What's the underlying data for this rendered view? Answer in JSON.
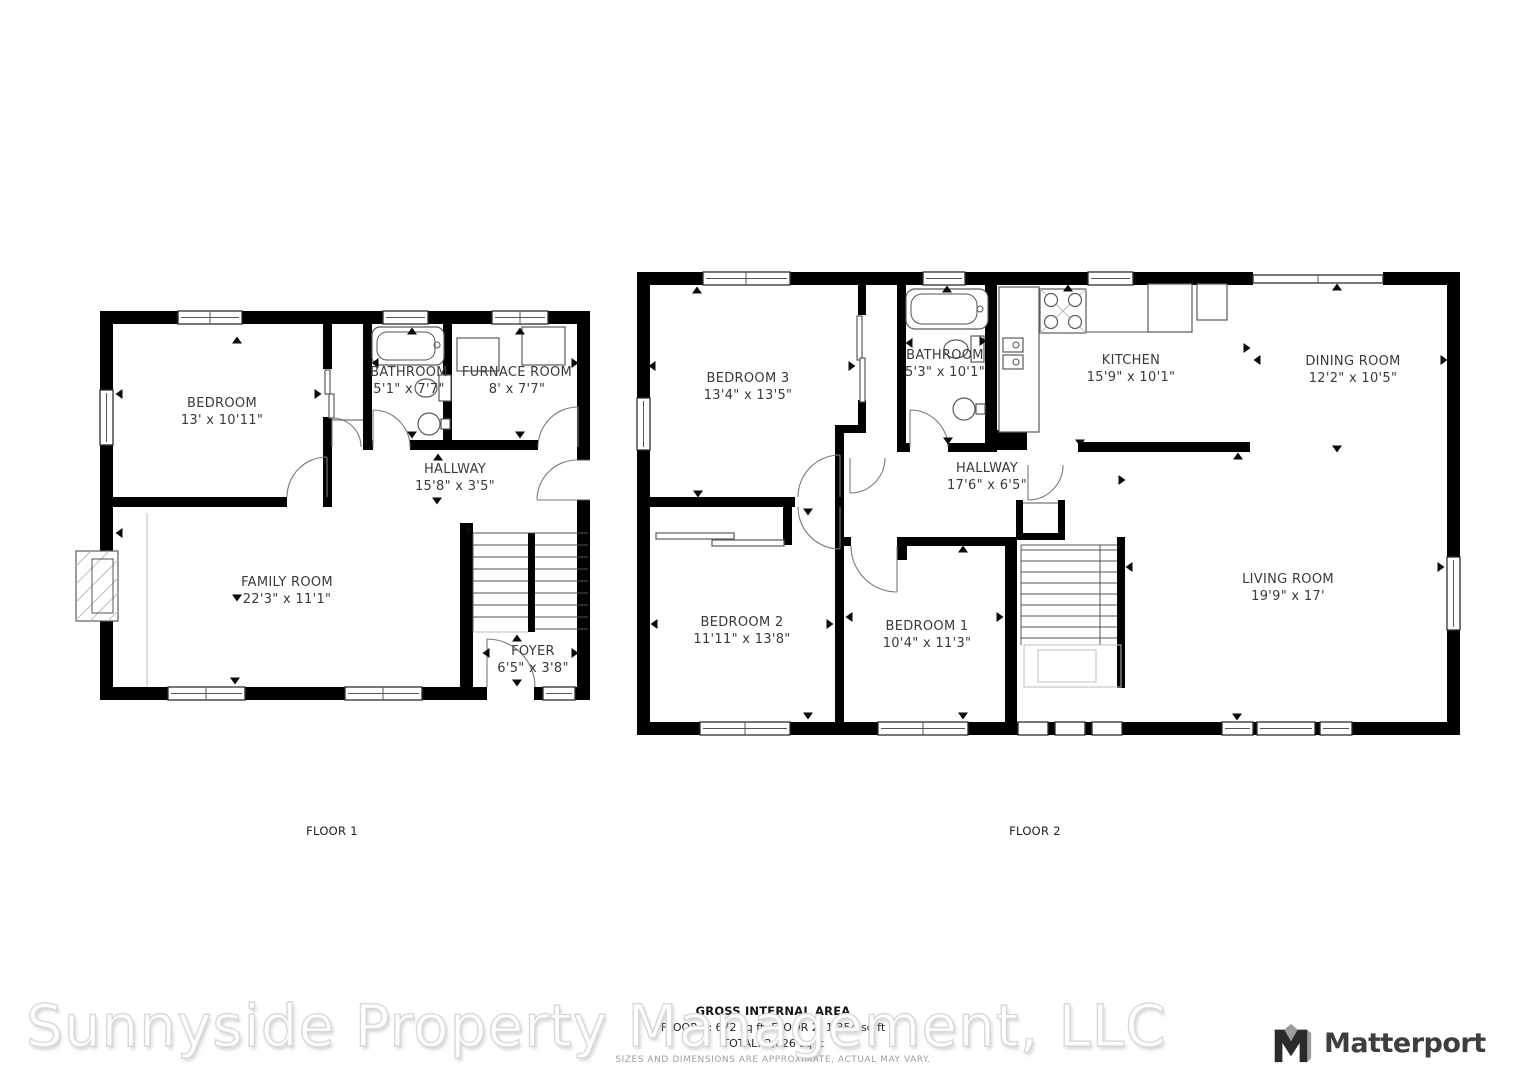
{
  "floors": [
    {
      "caption": "FLOOR 1",
      "rooms": [
        {
          "name": "BEDROOM",
          "dims": "13' x 10'11\""
        },
        {
          "name": "BATHROOM",
          "dims": "5'1\" x 7'7\""
        },
        {
          "name": "FURNACE ROOM",
          "dims": "8' x 7'7\""
        },
        {
          "name": "HALLWAY",
          "dims": "15'8\" x 3'5\""
        },
        {
          "name": "FAMILY ROOM",
          "dims": "22'3\" x 11'1\""
        },
        {
          "name": "FOYER",
          "dims": "6'5\" x 3'8\""
        }
      ]
    },
    {
      "caption": "FLOOR 2",
      "rooms": [
        {
          "name": "BEDROOM 3",
          "dims": "13'4\" x 13'5\""
        },
        {
          "name": "BATHROOM",
          "dims": "5'3\" x 10'1\""
        },
        {
          "name": "KITCHEN",
          "dims": "15'9\" x 10'1\""
        },
        {
          "name": "DINING ROOM",
          "dims": "12'2\" x 10'5\""
        },
        {
          "name": "HALLWAY",
          "dims": "17'6\" x 6'5\""
        },
        {
          "name": "BEDROOM 2",
          "dims": "11'11\" x 13'8\""
        },
        {
          "name": "BEDROOM 1",
          "dims": "10'4\" x 11'3\""
        },
        {
          "name": "LIVING ROOM",
          "dims": "19'9\" x 17'"
        }
      ]
    }
  ],
  "area_summary": {
    "title": "GROSS INTERNAL AREA",
    "line1": "FLOOR 1: 672 sq ft, FLOOR 2: 1,354 sq ft",
    "line2": "TOTAL: 2,026 sq ft",
    "disclaimer": "SIZES AND DIMENSIONS ARE APPROXIMATE, ACTUAL MAY VARY."
  },
  "watermark": "Sunnyside Property Management, LLC",
  "branding": {
    "name": "Matterport"
  },
  "colors": {
    "wall": "#000000",
    "label_text": "#3a3a3a",
    "watermark_fill": "#ffffff",
    "watermark_stroke": "#d9d9d9",
    "logo_text": "#3e3e3e",
    "logo_accent": "#9d9d9d",
    "disclaimer_text": "#9e9e9e"
  }
}
